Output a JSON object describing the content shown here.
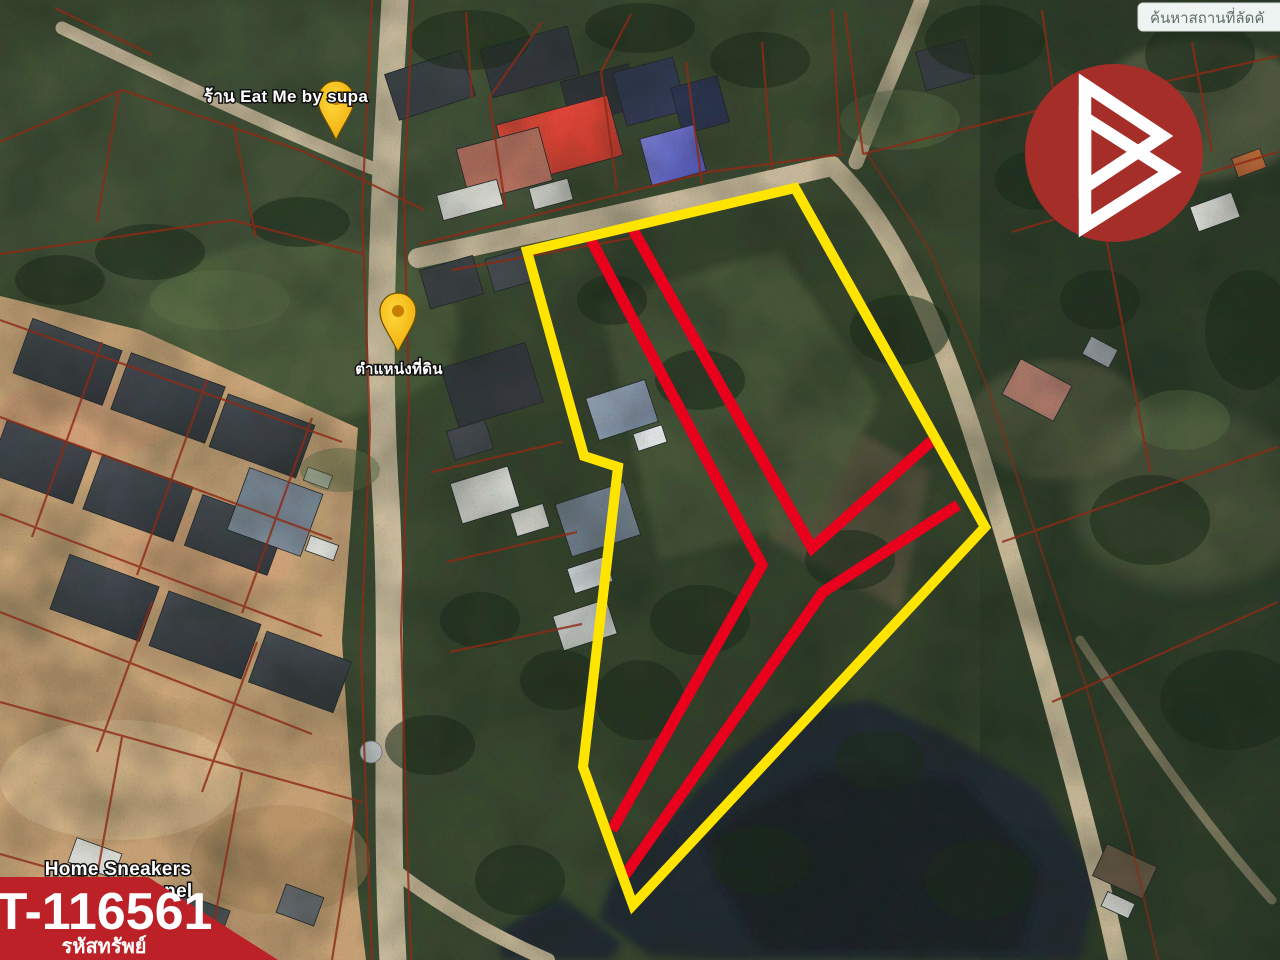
{
  "map": {
    "search_box_text": "ค้นหาสถานที่ลัดคั",
    "poi_labels": {
      "restaurant": "ร้าน Eat Me by supa",
      "land_position": "ตำแหน่งที่ดิน",
      "shop_line1": "Home Sneakers",
      "shop_line2": "By Roseranel"
    },
    "overlay": {
      "boundary_color": "#ffe400",
      "inner_line_color": "#e8001c",
      "cadastral_color": "#8d2a16"
    },
    "pin_color": "#f7b500",
    "pin_icon": "map-pin"
  },
  "branding": {
    "logo_color": "#a62e29",
    "logo_icon": "triangle-b-logo"
  },
  "listing": {
    "property_code": "T-116561",
    "property_code_label": "รหัสทรัพย์",
    "banner_color": "#bc2127"
  }
}
